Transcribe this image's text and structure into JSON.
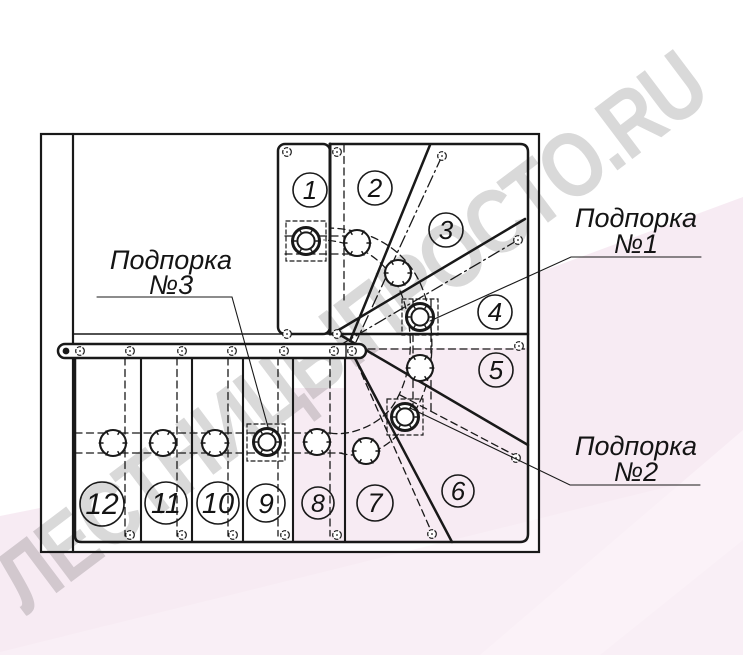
{
  "watermark": {
    "text": "ЛЕСТНИЦЫПРОСТО.RU"
  },
  "colors": {
    "line": "#191919",
    "paper": "#ffffff",
    "pink": "#f7ebf3",
    "pink_light": "#fbf2f8",
    "watermark": "#d9d9d9"
  },
  "labels": {
    "support1": {
      "line1": "Подпорка",
      "line2": "№1"
    },
    "support2": {
      "line1": "Подпорка",
      "line2": "№2"
    },
    "support3": {
      "line1": "Подпорка",
      "line2": "№3"
    }
  },
  "steps": [
    {
      "label": "1"
    },
    {
      "label": "2"
    },
    {
      "label": "3"
    },
    {
      "label": "4"
    },
    {
      "label": "5"
    },
    {
      "label": "6"
    },
    {
      "label": "7"
    },
    {
      "label": "8"
    },
    {
      "label": "9"
    },
    {
      "label": "10"
    },
    {
      "label": "11"
    },
    {
      "label": "12"
    }
  ]
}
